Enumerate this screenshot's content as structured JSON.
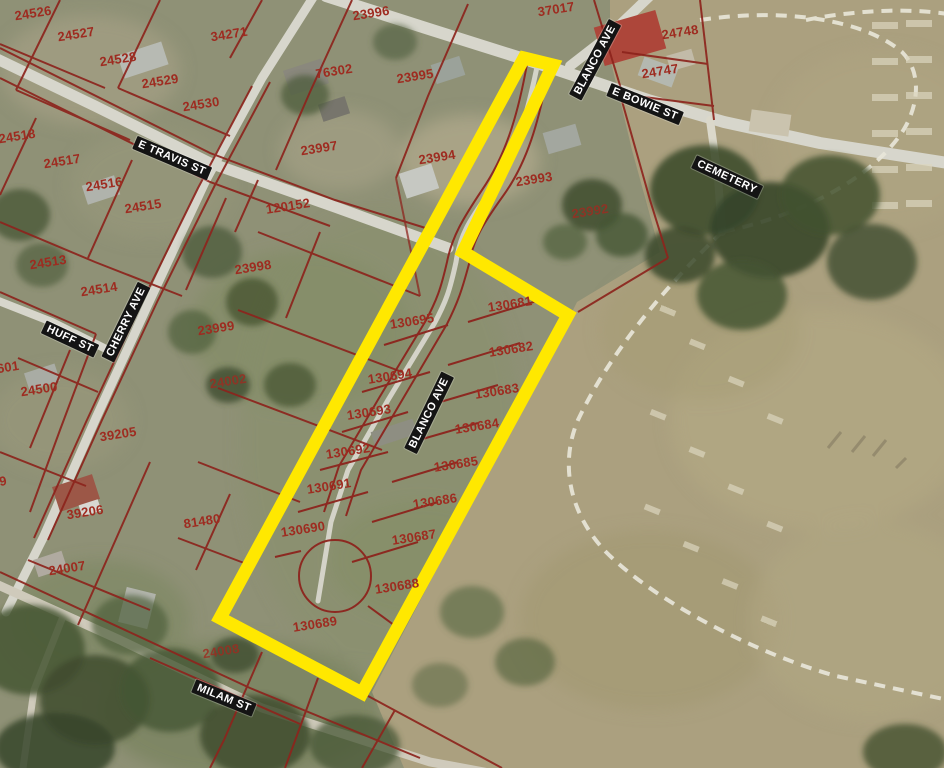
{
  "map": {
    "streets": {
      "e_travis": "E TRAVIS ST",
      "huff": "HUFF ST",
      "cherry": "CHERRY AVE",
      "blanco_ave_north": "BLANCO AVE",
      "e_bowie": "E BOWIE ST",
      "cemetery": "CEMETERY",
      "milam": "MILAM ST",
      "blanco_ave_sub": "BLANCO AVE"
    },
    "parcels": {
      "p24526": "24526",
      "p24527": "24527",
      "p24528": "24528",
      "p34271": "34271",
      "p24529": "24529",
      "p24530": "24530",
      "p23996": "23996",
      "p37017": "37017",
      "p24748": "24748",
      "p24747": "24747",
      "p76302": "76302",
      "p23995": "23995",
      "p23997": "23997",
      "p23994": "23994",
      "p23993": "23993",
      "p23992": "23992",
      "p24518": "24518",
      "p24517": "24517",
      "p24516": "24516",
      "p24515": "24515",
      "p120152": "120152",
      "p24513": "24513",
      "p24514": "24514",
      "p23998": "23998",
      "p23999": "23999",
      "p601": "601",
      "p24500": "24500",
      "p9": "9",
      "p39205": "39205",
      "p24002": "24002",
      "p39206": "39206",
      "p81480": "81480",
      "p24007": "24007",
      "p24008": "24008"
    },
    "subdivision_lots": {
      "l130681": "130681",
      "l130682": "130682",
      "l130683": "130683",
      "l130684": "130684",
      "l130685": "130685",
      "l130686": "130686",
      "l130687": "130687",
      "l130688": "130688",
      "l130689": "130689",
      "l130690": "130690",
      "l130691": "130691",
      "l130692": "130692",
      "l130693": "130693",
      "l130694": "130694",
      "l130695": "130695"
    },
    "colors": {
      "highlight_yellow": "#FFE800",
      "parcel_line": "#8D241D",
      "parcel_text": "#9E2B20",
      "street_label_bg": "#141414",
      "street_label_text": "#FFFFFF"
    }
  }
}
